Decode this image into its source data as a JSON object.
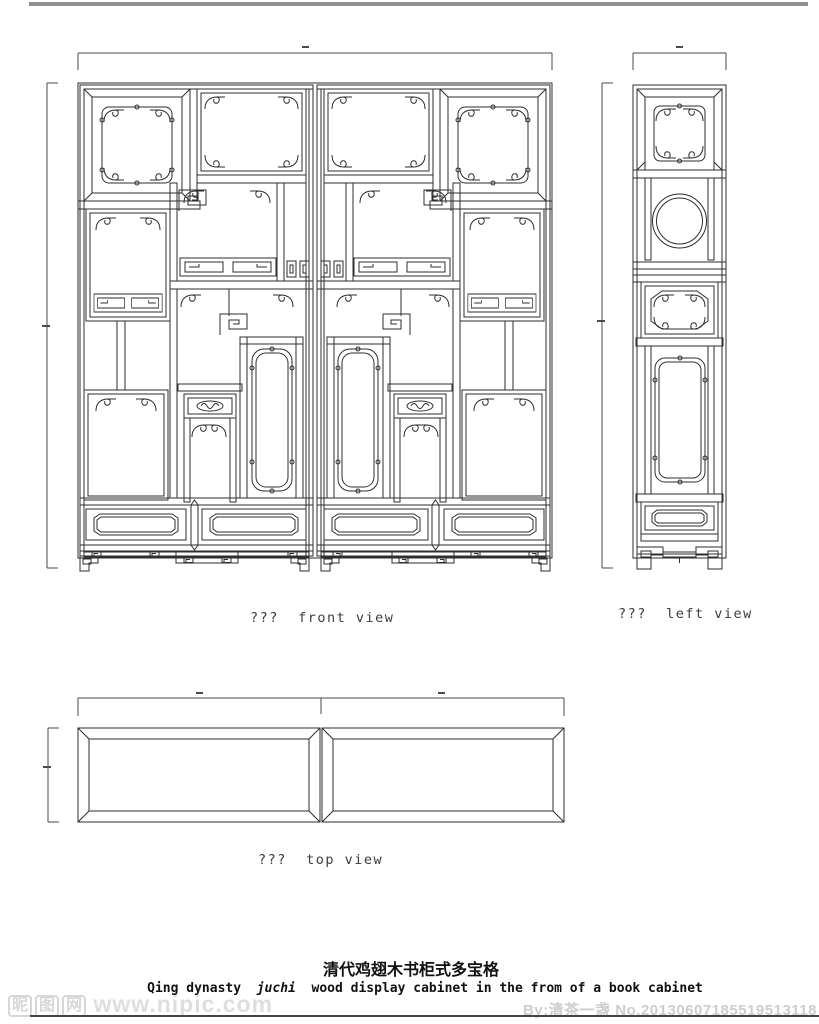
{
  "page": {
    "width": 819,
    "height": 1024,
    "background": "#ffffff"
  },
  "decor": {
    "top_bar_color": "#8f8f8f",
    "bottom_rule_color": "#434343"
  },
  "drawing": {
    "stroke_color": "#2e2e2e",
    "dimension_color": "#4a4a4a",
    "labels": {
      "front": "???  front view",
      "left": "???  left view",
      "top": "???  top view"
    }
  },
  "caption": {
    "title_zh": "清代鸡翅木书柜式多宝格",
    "english": {
      "prefix": "Qing dynasty  ",
      "italic": "juchi",
      "suffix": "  wood display cabinet in the from of a book cabinet"
    }
  },
  "watermark": {
    "logo_chars": [
      "昵",
      "图",
      "网"
    ],
    "site_url": "www.nipic.com",
    "credit": "By:清茶一盏 No.20130607185519513118"
  }
}
